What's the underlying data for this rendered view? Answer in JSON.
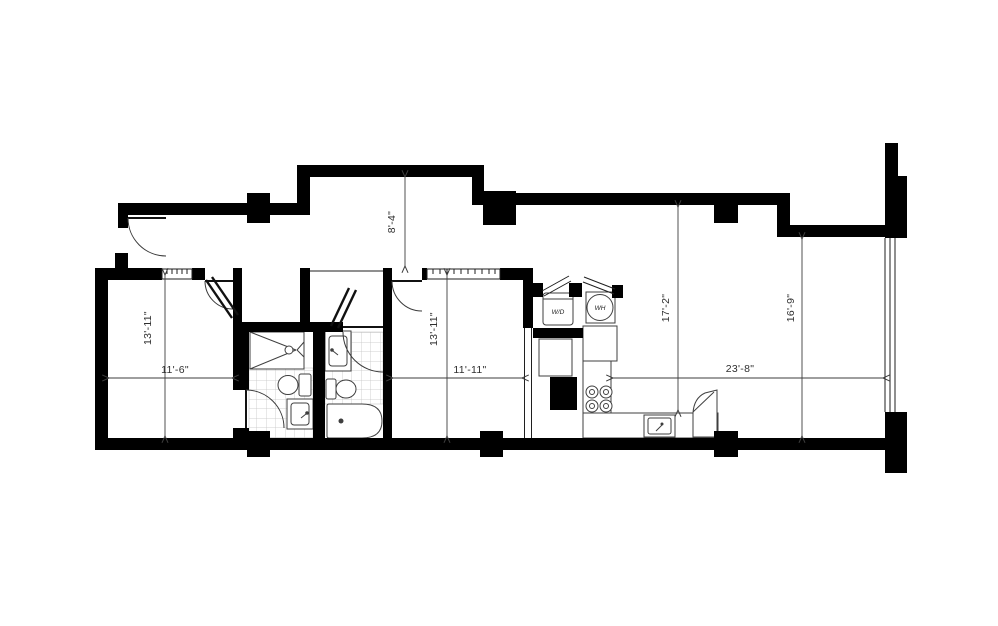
{
  "plan": {
    "labels": {
      "washer_dryer": "W/D",
      "water_heater": "WH"
    },
    "dimensions": {
      "entry_depth": "8'-4\"",
      "bed1_depth": "13'-11\"",
      "bed1_width": "11'-6\"",
      "bed2_depth": "13'-11\"",
      "bed2_width": "11'-11\"",
      "living_depth_left": "17'-2\"",
      "living_depth_right": "16'-9\"",
      "living_width": "23'-8\""
    },
    "colors": {
      "wall": "#000000",
      "dimension_line": "#3d3d3d",
      "tile_grid": "#c4c4c4",
      "background": "#ffffff"
    }
  }
}
